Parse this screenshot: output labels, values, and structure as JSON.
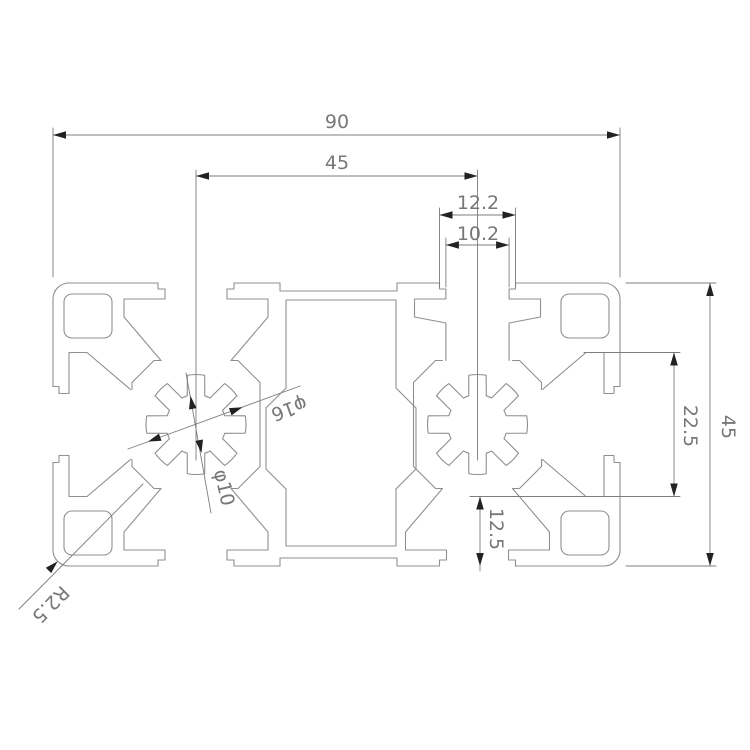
{
  "page": {
    "background": "#ffffff"
  },
  "colors": {
    "profile-line": "#8f8f8f",
    "dimension-line": "#7d7d7d",
    "arrow": "#222222",
    "text": "#777777"
  },
  "drawing": {
    "type": "technical-cross-section",
    "dimensions": {
      "overall_width": "90",
      "bore_center_distance": "45",
      "top_channel_outer_width": "12.2",
      "top_channel_inner_width": "10.2",
      "overall_height": "45",
      "side_slot_span": "22.5",
      "bottom_offset": "12.5",
      "bore_outer_diameter": "φ16",
      "bore_inner_diameter": "φ10",
      "corner_radius": "R2.5"
    }
  }
}
